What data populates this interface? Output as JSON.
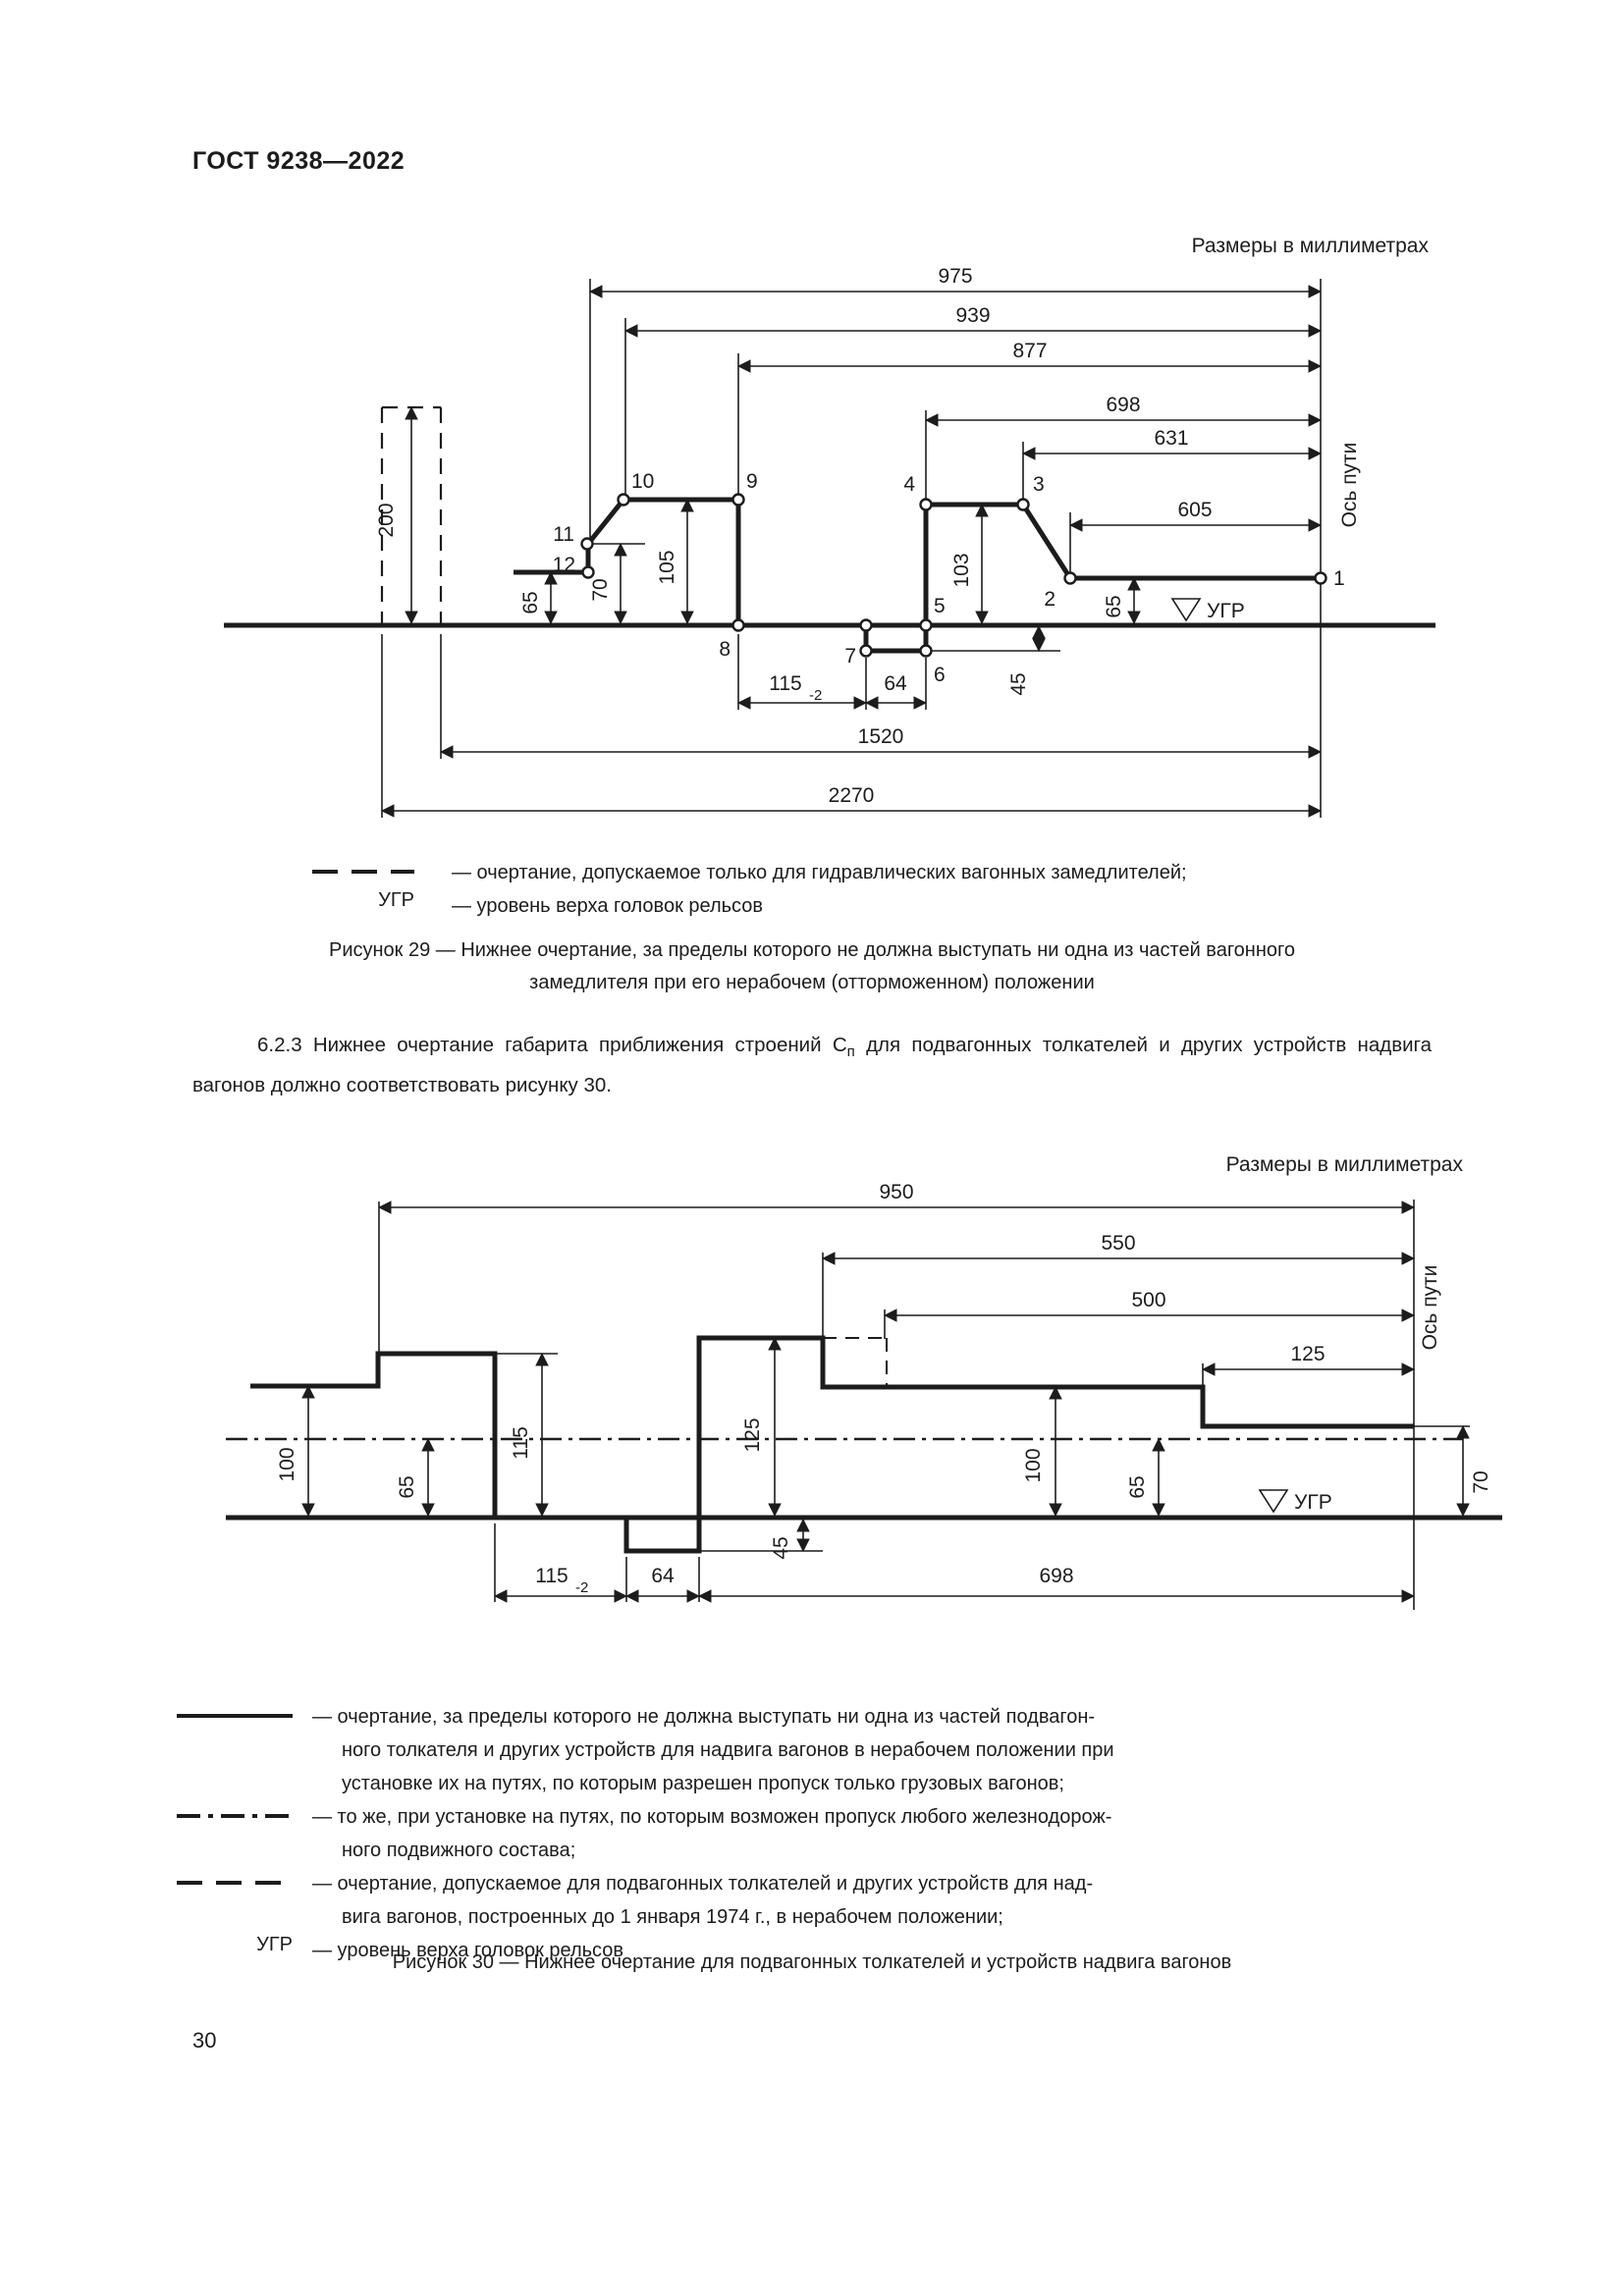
{
  "page": {
    "header": "ГОСТ 9238—2022",
    "page_number": "30"
  },
  "fig29": {
    "units_label": "Размеры в миллиметрах",
    "axis_label": "Ось пути",
    "ugr_label": "УГР",
    "dims": {
      "d975": "975",
      "d939": "939",
      "d877": "877",
      "d698": "698",
      "d631": "631",
      "d605": "605",
      "d200": "200",
      "d65l": "65",
      "d70": "70",
      "d105": "105",
      "d115": "115",
      "d115sub": "-2",
      "d64": "64",
      "d45": "45",
      "d103": "103",
      "d65r": "65",
      "d1520": "1520",
      "d2270": "2270"
    },
    "points": {
      "p1": "1",
      "p2": "2",
      "p3": "3",
      "p4": "4",
      "p5": "5",
      "p6": "6",
      "p7": "7",
      "p8": "8",
      "p9": "9",
      "p10": "10",
      "p11": "11",
      "p12": "12"
    },
    "legend": {
      "item1_label": "— очертание, допускаемое только для гидравлических вагонных замедлителей;",
      "item2_key": "УГР",
      "item2_label": "— уровень верха головок рельсов"
    },
    "caption_line1": "Рисунок 29 — Нижнее очертание, за пределы которого не должна выступать ни одна из частей вагонного",
    "caption_line2": "замедлителя при его нерабочем (отторможенном) положении"
  },
  "paragraph": {
    "before": "6.2.3 Нижнее очертание габарита приближения строений С",
    "sub": "п",
    "after": " для подвагонных толкателей и других устройств надвига вагонов должно соответствовать рисунку 30."
  },
  "fig30": {
    "units_label": "Размеры в миллиметрах",
    "axis_label": "Ось пути",
    "ugr_label": "УГР",
    "dims": {
      "d950": "950",
      "d550": "550",
      "d500": "500",
      "d125top": "125",
      "d100l": "100",
      "d65l": "65",
      "d115v": "115",
      "d125mid": "125",
      "d45": "45",
      "d100r": "100",
      "d65r": "65",
      "d70": "70",
      "d115b": "115",
      "d115bsub": "-2",
      "d64": "64",
      "d698": "698"
    },
    "legend": {
      "item1_lines": [
        "— очертание, за пределы которого не должна выступать ни одна из частей подвагон-",
        "ного толкателя и других устройств для надвига вагонов в нерабочем положении при",
        "установке их на путях, по которым разрешен пропуск только грузовых вагонов;"
      ],
      "item2_lines": [
        "— то же, при установке на путях, по которым возможен пропуск любого железнодорож-",
        "ного подвижного состава;"
      ],
      "item3_lines": [
        "— очертание, допускаемое для подвагонных толкателей и других устройств для над-",
        "вига вагонов, построенных до 1 января 1974 г., в нерабочем положении;"
      ],
      "item4_key": "УГР",
      "item4_label": "— уровень верха головок рельсов"
    },
    "caption": "Рисунок 30 — Нижнее очертание для подвагонных толкателей и устройств надвига вагонов"
  }
}
